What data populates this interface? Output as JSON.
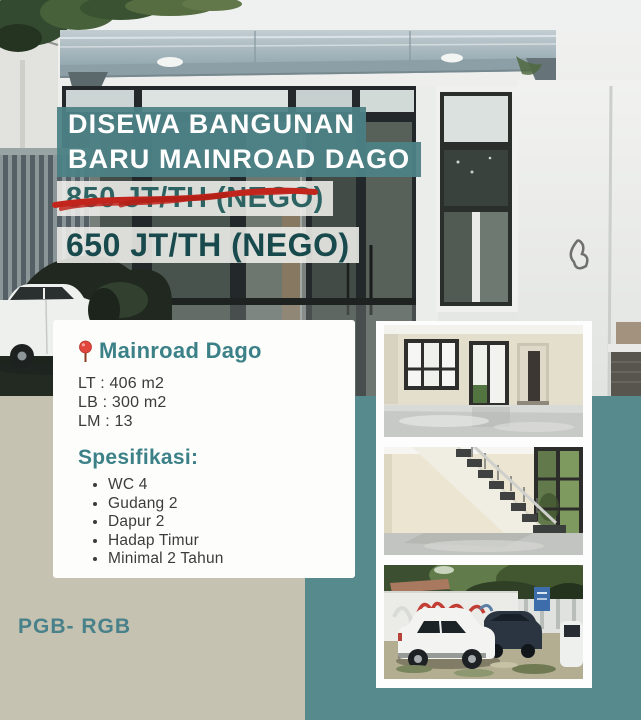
{
  "flyer": {
    "headline": {
      "line1": "DISEWA BANGUNAN",
      "line2": "BARU MAINROAD DAGO"
    },
    "price_old": "850 JT/TH (NEGO)",
    "price_new": "650 JT/TH (NEGO)",
    "agency_code": "PGB- RGB"
  },
  "property_card": {
    "location": "Mainroad Dago",
    "details": [
      "LT : 406 m2",
      "LB : 300 m2",
      "LM : 13"
    ],
    "spec_heading": "Spesifikasi:",
    "specs": [
      "WC 4",
      "Gudang 2",
      "Dapur 2",
      "Hadap Timur",
      "Minimal 2 Tahun"
    ]
  },
  "gallery": {
    "photos": [
      "interior-showroom",
      "interior-staircase",
      "exterior-parking-front"
    ]
  },
  "icons": {
    "location_pin": "location-pin-icon"
  },
  "colors": {
    "banner_teal": "#4d8286",
    "background_teal": "#578a8c",
    "background_beige": "#c6c2b2",
    "accent_teal": "#3b8187",
    "price_old_text": "#2d6463",
    "price_new_text": "#18494c",
    "strike_red": "#c1251c",
    "pin_red": "#e0463c",
    "body_text": "#3c3c3c",
    "headline_text": "#fefefe",
    "footer_teal": "#49818a"
  }
}
